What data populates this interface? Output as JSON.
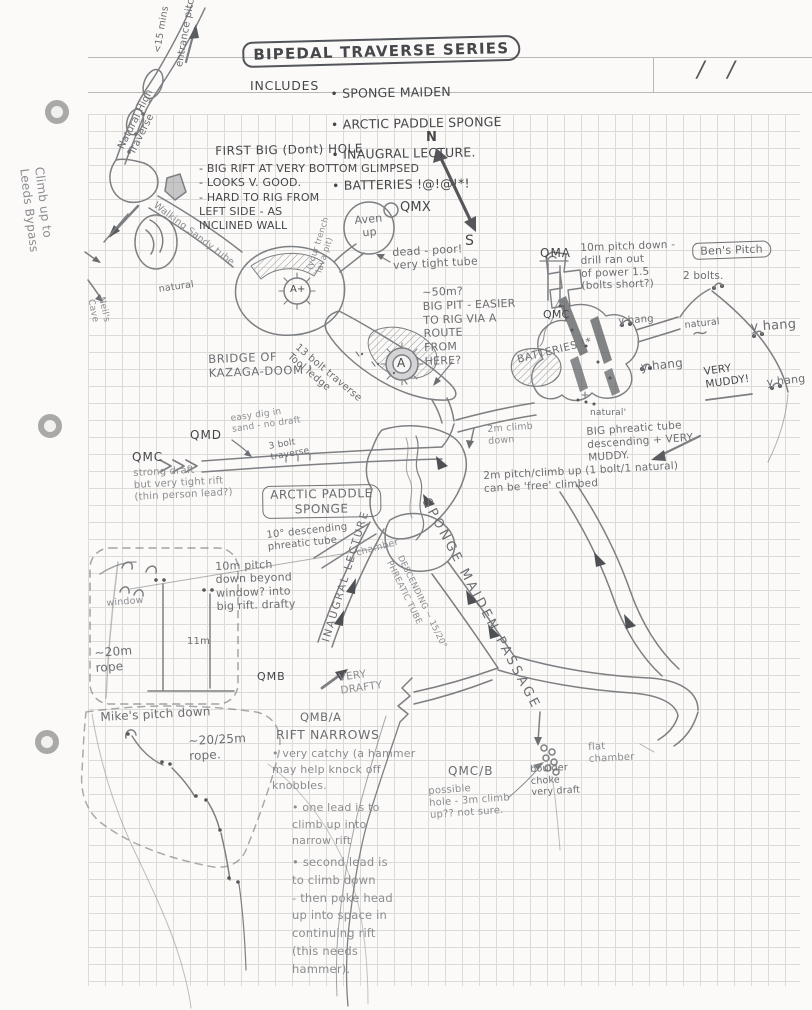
{
  "page": {
    "corner_slashes": "/ /",
    "header": {
      "title": "BIPEDAL TRAVERSE SERIES",
      "includes_label": "INCLUDES",
      "includes": [
        "• SPONGE MAIDEN",
        "• ARCTIC PADDLE SPONGE",
        "• INAUGRAL LECTURE.",
        "• BATTERIES !@!@!*!"
      ]
    }
  },
  "labels": {
    "entrance_pitch": "entrance pitch",
    "entrance_time": "<15 mins",
    "natural_high_traverse": "Natural High\nTraverse",
    "climb_leeds": "Climb up to\nLeeds Bypass",
    "neils_cave": "Neil's\nCave",
    "walking_sandy": "Walking Sandy tube",
    "natural_w": "natural",
    "fbh_title": "FIRST BIG (Dont) HOLE",
    "fbh_notes": "- BIG RIFT AT VERY BOTTOM GLIMPSED\n- LOOKS V. GOOD.\n- HARD TO RIG FROM\nLEFT SIDE - AS\nINCLINED WALL",
    "lava_pit": "(your trench\nlava pit)",
    "aven_up": "Aven\nup",
    "qmx": "QMX",
    "compass_n": "N",
    "compass_s": "S",
    "dead_poor": "dead - poor!\nvery tight tube",
    "big_pit": "~50m?\nBIG PIT - EASIER\nTO RIG VIA A\nROUTE\nFROM\nHERE?",
    "qma": "QMA",
    "qma_note": "10m pitch down -\ndrill ran out\nof power 1.5\n(bolts short?)",
    "bens_pitch": "Ben's Pitch",
    "two_bolts": "2 bolts.",
    "qmc_r": "QMC",
    "yhang1": "y hang",
    "yhang2": "y hang",
    "yhang3": "y hang",
    "yhang4": "y hang",
    "natural_r1": "natural",
    "natural_r2": "natural'",
    "very_muddy": "VERY\nMUDDY!",
    "batteries": "BATTERIES !*",
    "bridge": "BRIDGE OF\nKAZAGA-DOOM !",
    "bolt13": "13 bolt traverse\nTool ledge",
    "a_plus": "A+",
    "a_circ": "A",
    "big_phreatic": "BIG phreatic tube\ndescending + VERY\nMUDDY.",
    "climb2m": "2m climb\ndown",
    "pitch2m": "2m pitch/climb up (1 bolt/1 natural)\ncan be 'free' climbed",
    "qmd": "QMD",
    "qmd_note": "easy dig in\nsand - no draft",
    "qmc_l": "QMC",
    "strong_draft": "strong draft\nbut very tight rift\n(thin person lead?)",
    "bolt3": "3 bolt\ntraverse",
    "aps": "ARCTIC PADDLE\nSPONGE",
    "tube10": "10° descending\nphreatic tube",
    "inaugral": "INAUGRAL LECTURE",
    "chamber": "chamber",
    "smp": "SPONGE MAIDEN PASSAGE",
    "desc_tube": "DESCENDING ~ 15/20°\nPHREATIC TUBE",
    "pitch10m": "10m pitch\ndown beyond\nwindow? into\nbig rift. drafty",
    "window": "window",
    "m11": "11m",
    "rope20": "~20m\nrope",
    "mikes": "Mike's pitch down",
    "mikes_rope": "~20/25m\nrope.",
    "qmb": "QMB",
    "very_drafty": "VERY\nDRAFTY",
    "qmba": "QMB/A",
    "rift_narrows": "RIFT NARROWS",
    "rn1": "• very catchy (a hammer\nmay help knock off\nknobbles.",
    "rn2": "• one lead is to\nclimb up into\nnarrow rift",
    "rn3": "• second lead is\nto climb down\n- then poke head\nup into space in\ncontinuing rift\n(this needs\nhammer).",
    "qmcb": "QMC/B",
    "qmcb_note": "possible\nhole - 3m climb\nup?? not sure.",
    "boulder": "boulder\nchoke\nvery draft",
    "flat_chamber": "flat\nchamber"
  }
}
